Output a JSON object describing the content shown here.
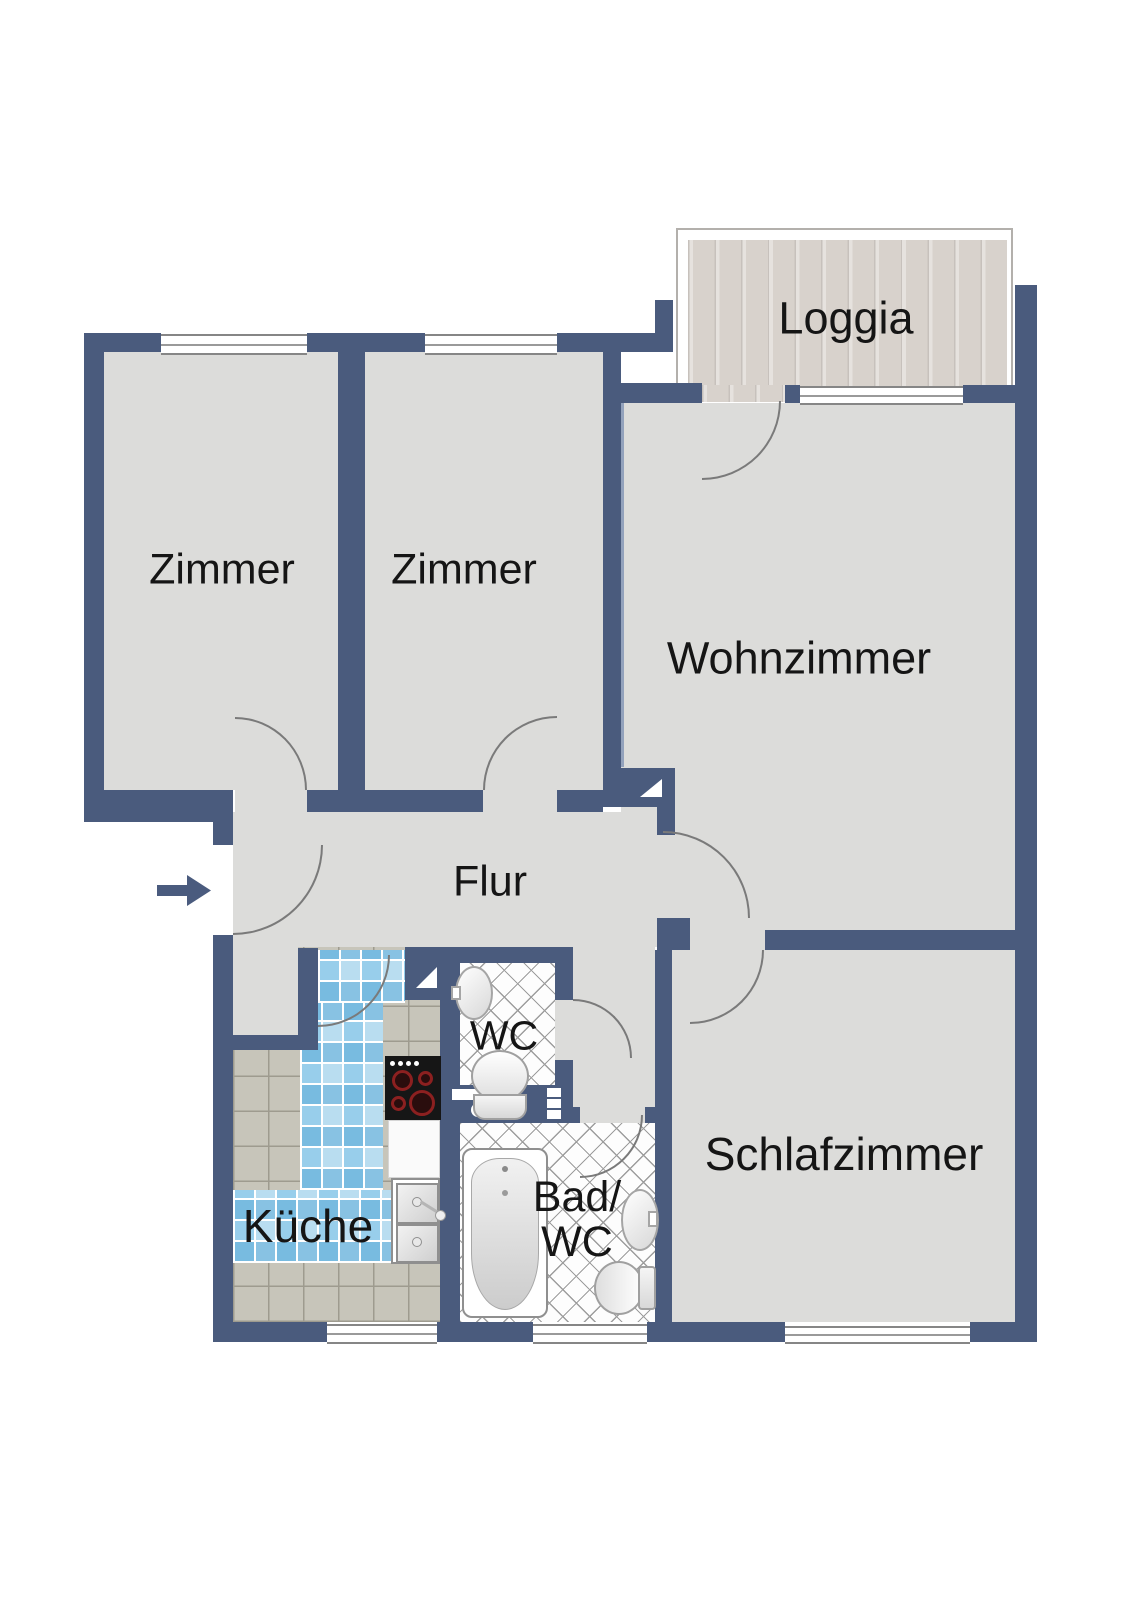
{
  "floor_plan": {
    "rooms": [
      {
        "id": "loggia",
        "label": "Loggia"
      },
      {
        "id": "zimmer-1",
        "label": "Zimmer"
      },
      {
        "id": "zimmer-2",
        "label": "Zimmer"
      },
      {
        "id": "wohnzimmer",
        "label": "Wohnzimmer"
      },
      {
        "id": "flur",
        "label": "Flur"
      },
      {
        "id": "wc",
        "label": "WC"
      },
      {
        "id": "kueche",
        "label": "Küche"
      },
      {
        "id": "bad-wc",
        "label": "Bad/WC",
        "label_line1": "Bad/",
        "label_line2": "WC"
      },
      {
        "id": "schlafzimmer",
        "label": "Schlafzimmer"
      }
    ],
    "entrance": {
      "icon": "arrow-right-icon"
    },
    "fixtures": [
      "bathtub",
      "toilet",
      "wash-basin",
      "stove",
      "double-sink",
      "installation-shaft",
      "door-swing",
      "window"
    ],
    "colors": {
      "wall": "#4a5b7d",
      "floor": "#dcdcda",
      "wood": "#d8d2cc",
      "tile_blue": "#a8d4ea",
      "tile_gray": "#c7c5ba",
      "arc": "#7a7a7a",
      "page": "#ffffff",
      "text": "#151515"
    }
  }
}
